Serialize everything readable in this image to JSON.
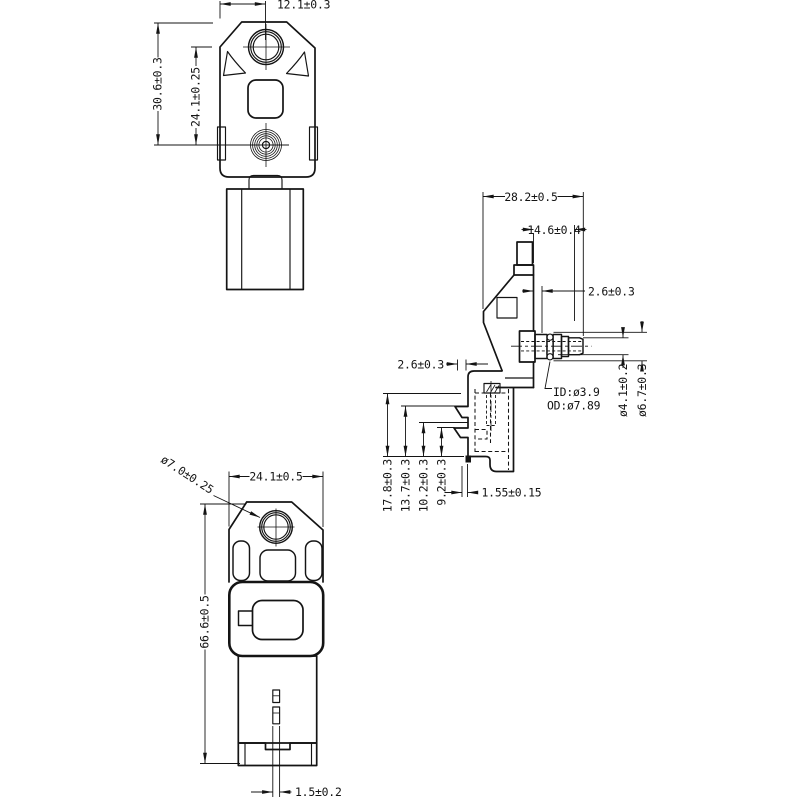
{
  "drawing": {
    "background": "#ffffff",
    "line_color": "#141414",
    "views": {
      "front_top": {
        "dim_port_offset": "12.1±0.3",
        "dim_height_outer": "30.6±0.3",
        "dim_height_inner": "24.1±0.25"
      },
      "side": {
        "dim_depth": "28.2±0.5",
        "dim_port_length": "14.6±0.4",
        "dim_step_front": "2.6±0.3",
        "dim_step_rear": "2.6±0.3",
        "leader_inner_dia": "ID:ø3.9",
        "leader_outer_dia": "OD:ø7.89",
        "dim_tip_dia": "ø4.1±0.2",
        "dim_barb_dia": "ø6.7±0.3",
        "dim_h1": "17.8±0.3",
        "dim_h2": "13.7±0.3",
        "dim_h3": "10.2±0.3",
        "dim_h4": "9.2±0.3",
        "dim_foot_lip": "1.55±0.15"
      },
      "front_full": {
        "dim_port_dia": "ø7.0±0.25",
        "dim_width": "24.1±0.5",
        "dim_height": "66.6±0.5",
        "dim_terminal": "1.5±0.2"
      }
    }
  }
}
